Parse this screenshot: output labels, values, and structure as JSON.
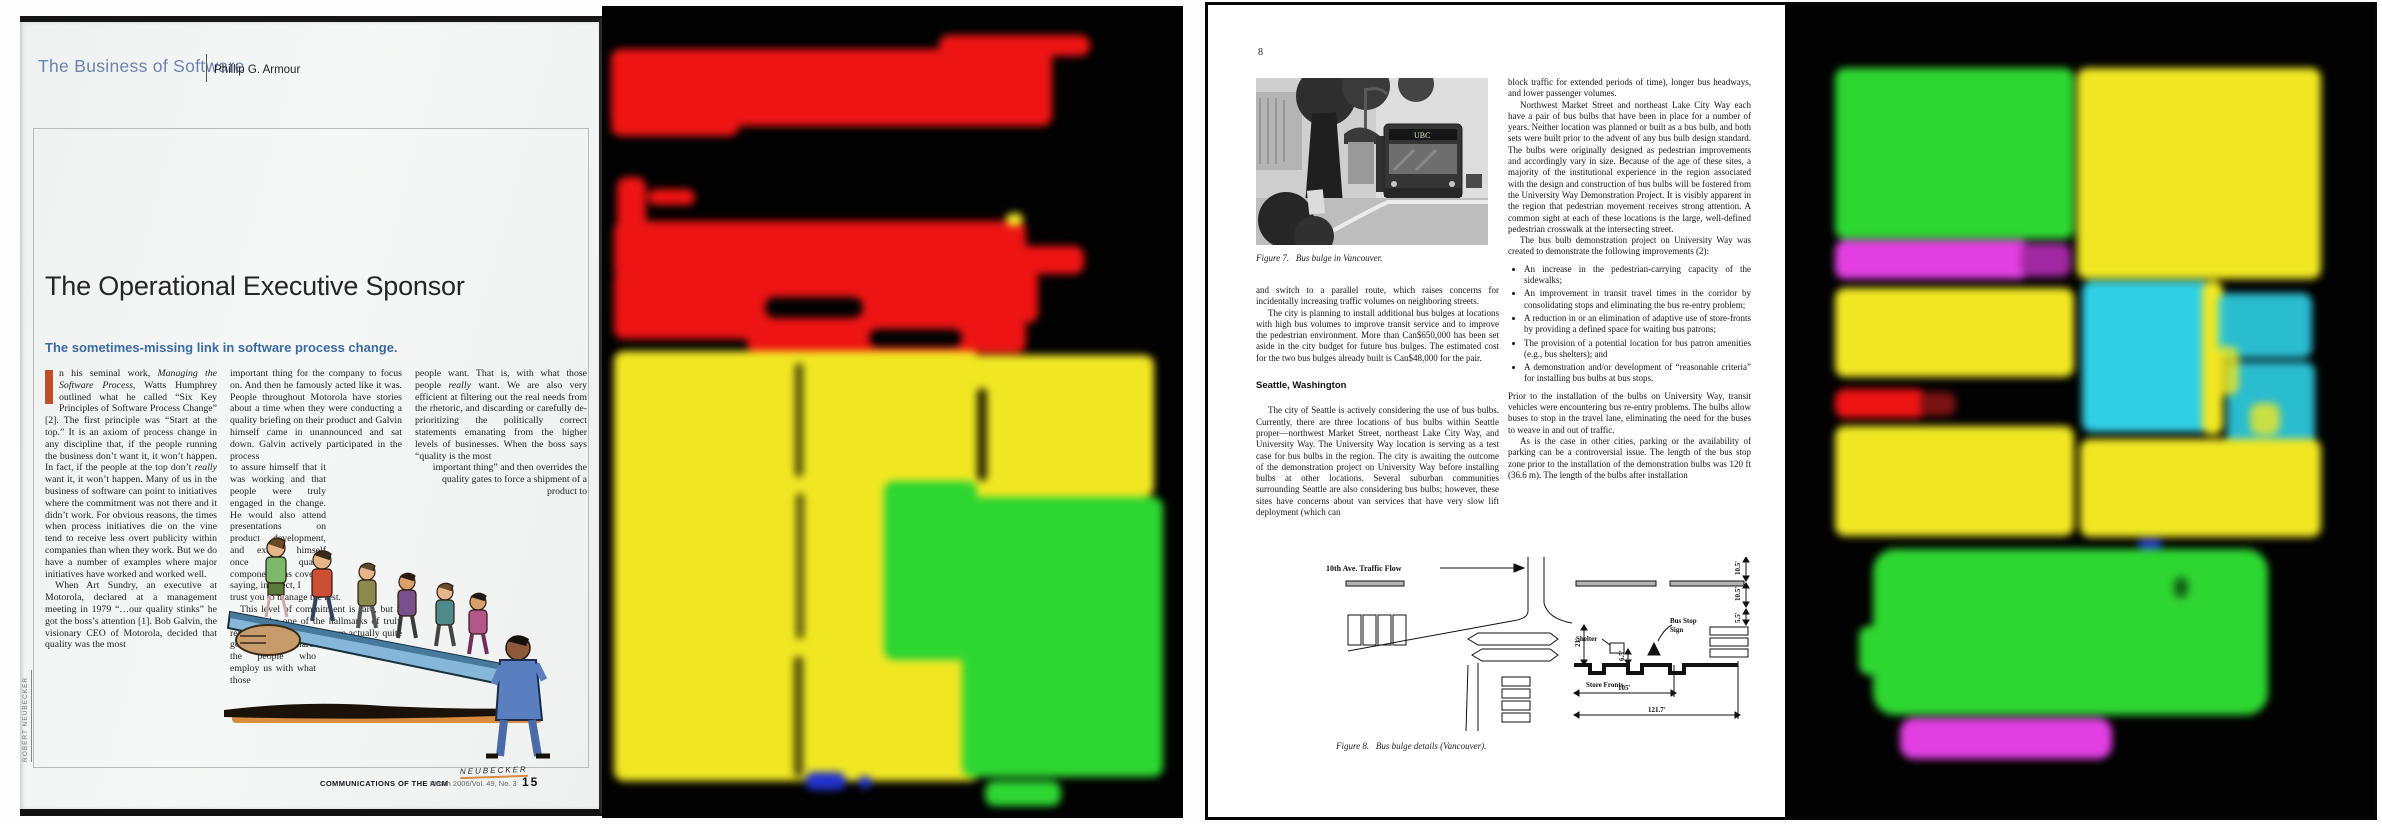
{
  "palette": {
    "background": "#020202",
    "red": "#ee1414",
    "dark_red": "#7a1212",
    "yellow": "#f0e722",
    "green": "#2ed632",
    "magenta": "#e23fe2",
    "dark_magenta": "#a028a0",
    "cyan": "#2fd0e6",
    "blue": "#2233cc"
  },
  "left_panel": {
    "page": {
      "series_title": "The Business of Software",
      "author": "Phillip G. Armour",
      "title": "The Operational Executive Sponsor",
      "subtitle": "The sometimes-missing link in software process change.",
      "column1": {
        "p1_start": "n his seminal work, ",
        "p1_italic1": "Managing the Software Process",
        "p1_mid": ", Watts Humphrey outlined what he called “Six Key Principles of Software Process Change” [2]. The first principle was “Start at the top.” It is an axiom of process change in any discipline that, if the people running the business don’t want it, it won’t happen. In fact, if the people at the top don’t ",
        "p1_italic2": "really",
        "p1_end": " want it, it won’t happen. Many of us in the business of software can point to initiatives where the commitment was not there and it didn’t work. For obvious reasons, the times when process initiatives die on the vine tend to receive less overt publicity within companies than when they work. But we do have a number of examples where major initiatives have worked and worked well.",
        "p2": "When Art Sundry, an executive at Motorola, declared at a management meeting in 1979 “…our quality stinks” he got the boss’s attention [1]. Bob Galvin, the visionary CEO of Motorola, decided that quality was the most"
      },
      "column2": {
        "b1": "important thing for the company to focus on. And then he famously acted like it was. People throughout Motorola have stories about a time when they were conducting a quality briefing on their product and Galvin himself came in unannounced and sat down. Galvin actively participated in the process",
        "b2": "to assure himself that it was working and that people were truly engaged in the change. He would also attend presentations on product development, and excuse himself once the quality component was covered saying, in effect, I",
        "b3": "trust you to manage the rest.",
        "b4": "This level of commitment is rare, but it seems to be one of the hallmarks of truly revolutionary change. We are actually quite good at working hard to provide",
        "b5": "the people who employ us with what those"
      },
      "column3": {
        "p1_start": "people want. That is, with what those people ",
        "p1_italic": "really",
        "p1_mid": " want. We are also very efficient at filtering out the real needs from the rhetoric, and discarding or carefully de-prioritizing the politically correct statements emanating from the higher levels of businesses. When the boss says “quality is the most",
        "p1_tail": "important thing” and then overrides the quality gates to force a shipment of a product to"
      },
      "illustration_credit": "ROBERT NEUBECKER",
      "signature": "NEUBECKER",
      "footer": {
        "publication": "COMMUNICATIONS OF THE ACM",
        "issue": "March 2006/Vol. 49, No. 3",
        "page_number": "15"
      }
    }
  },
  "right_panel": {
    "page": {
      "page_number": "8",
      "photo_bus_sign": "UBC",
      "figure7_caption": "Figure 7.   Bus bulge in Vancouver.",
      "col_left": {
        "p1": "and switch to a parallel route, which raises concerns for incidentally increasing traffic volumes on neighboring streets.",
        "p2": "The city is planning to install additional bus bulges at locations with high bus volumes to improve transit service and to improve the pedestrian environment. More than Can$650,000 has been set aside in the city budget for future bus bulges. The estimated cost for the two bus bulges already built is Can$48,000 for the pair.",
        "heading": "Seattle, Washington",
        "p3": "The city of Seattle is actively considering the use of bus bulbs. Currently, there are three locations of bus bulbs within Seattle proper—northwest Market Street, northeast Lake City Way, and University Way. The University Way location is serving as a test case for bus bulbs in the region. The city is awaiting the outcome of the demonstration project on University Way before installing bulbs at other locations. Several suburban communities surrounding Seattle are also considering bus bulbs; however, these sites have concerns about van services that have very slow lift deployment (which can"
      },
      "col_right": {
        "p1": "block traffic for extended periods of time), longer bus headways, and lower passenger volumes.",
        "p2": "Northwest Market Street and northeast Lake City Way each have a pair of bus bulbs that have been in place for a number of years. Neither location was planned or built as a bus bulb, and both sets were built prior to the advent of any bus bulb design standard. The bulbs were originally designed as pedestrian improvements and accordingly vary in size. Because of the age of these sites, a majority of the institutional experience in the region associated with the design and construction of bus bulbs will be fostered from the University Way Demonstration Project. It is visibly apparent in the region that pedestrian movement receives strong attention. A common sight at each of these locations is the large, well-defined pedestrian crosswalk at the intersecting street.",
        "p3": "The bus bulb demonstration project on University Way was created to demonstrate the following improvements (2):",
        "bullets": [
          "An increase in the pedestrian-carrying capacity of the sidewalks;",
          "An improvement in transit travel times in the corridor by consolidating stops and eliminating the bus re-entry problem;",
          "A reduction in or an elimination of adaptive use of store-fronts by providing a defined space for waiting bus patrons;",
          "The provision of a potential location for bus patron amenities (e.g., bus shelters); and",
          "A demonstration and/or development of “reasonable criteria” for installing bus bulbs at bus stops."
        ],
        "p4": "Prior to the installation of the bulbs on University Way, transit vehicles were encountering bus re-entry problems. The bulbs allow buses to stop in the travel lane, eliminating the need for the buses to weave in and out of traffic.",
        "p5": "As is the case in other cities, parking or the availability of parking can be a controversial issue. The length of the bus stop zone prior to the installation of the demonstration bulbs was 120 ft (36.6 m). The length of the bulbs after installation"
      },
      "figure8": {
        "caption": "Figure 8.   Bus bulge details (Vancouver).",
        "label_traffic_flow": "10th Ave. Traffic Flow",
        "label_bus_stop_1": "Bus Stop",
        "label_bus_stop_2": "Sign",
        "label_shelter": "Shelter",
        "label_store_fronts": "Store Fronts",
        "dim_21": "21'",
        "dim_65": "6.5'",
        "dim_105": "105'",
        "dim_1217": "121.7'",
        "dim_105a": "10.5'",
        "dim_105b": "10.5'",
        "dim_55": "5.5'"
      }
    }
  }
}
